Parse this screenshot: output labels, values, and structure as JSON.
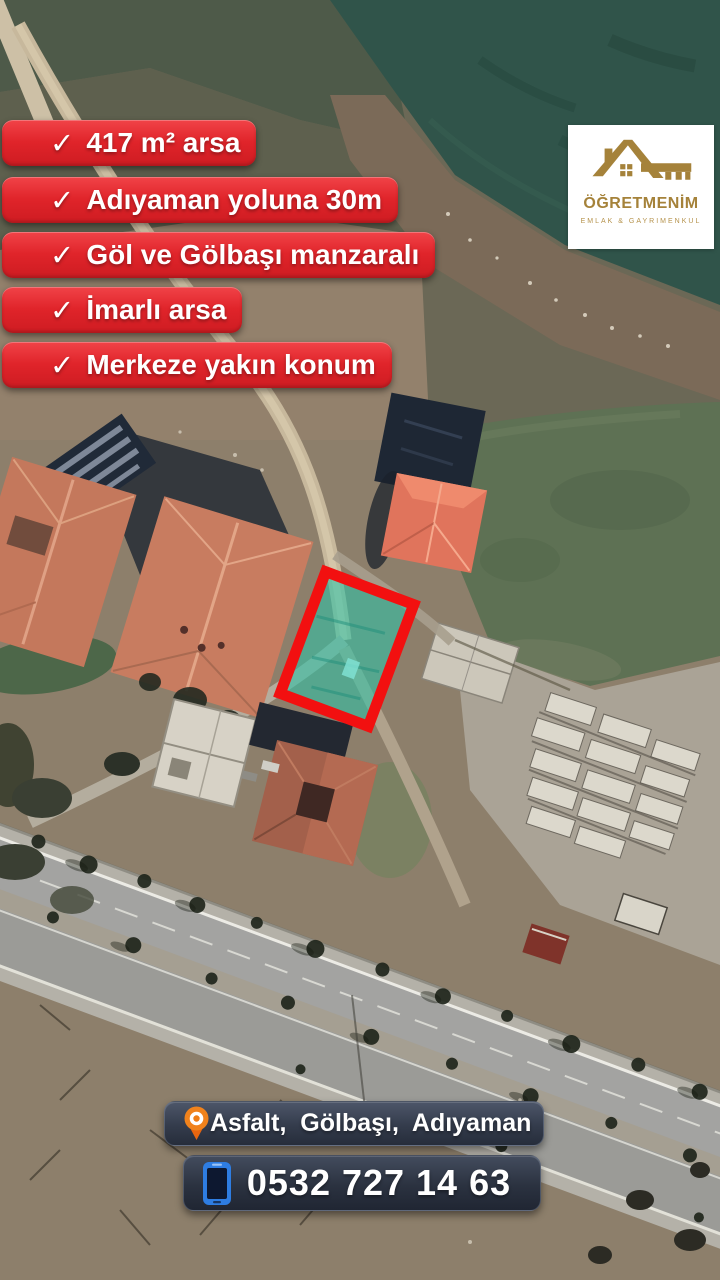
{
  "banners": [
    {
      "check": "✓",
      "label": "417 m² arsa"
    },
    {
      "check": "✓",
      "label": "Adıyaman yoluna 30m"
    },
    {
      "check": "✓",
      "label": "Göl ve Gölbaşı manzaralı"
    },
    {
      "check": "✓",
      "label": "İmarlı arsa"
    },
    {
      "check": "✓",
      "label": "Merkeze yakın konum"
    }
  ],
  "logo": {
    "name": "ÖĞRETMENİM",
    "subtitle": "EMLAK & GAYRIMENKUL",
    "icon": "house-key-icon",
    "gold": "#a5823a"
  },
  "contact": {
    "location": "Asfalt,  Gölbaşı,  Adıyaman",
    "phone": "0532 727 14 63"
  },
  "map": {
    "type": "satellite-photo",
    "highlighted_parcel": {
      "fill": "#2fc3a7",
      "border": "#f21010",
      "shape": "rotated-rectangle"
    },
    "features": [
      "lake-field",
      "dirt-road",
      "highway",
      "school-buildings",
      "construction-site"
    ]
  },
  "colors": {
    "banner_red": "#e0242a",
    "bar_slate": "#343c4c",
    "pin_orange": "#f0821c",
    "phone_blue": "#2e7de2"
  }
}
